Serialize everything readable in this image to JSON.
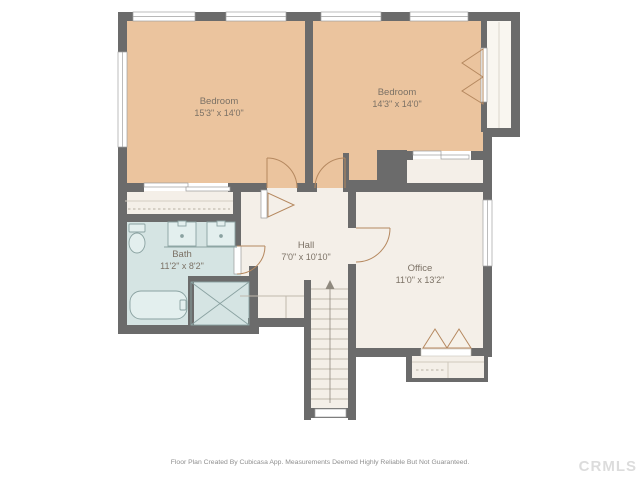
{
  "plan": {
    "rooms": [
      {
        "name": "Bedroom",
        "dimensions": "15'3\" x 14'0\""
      },
      {
        "name": "Bedroom",
        "dimensions": "14'3\" x 14'0\""
      },
      {
        "name": "Bath",
        "dimensions": "11'2\" x 8'2\""
      },
      {
        "name": "Hall",
        "dimensions": "7'0\" x 10'10\""
      },
      {
        "name": "Office",
        "dimensions": "11'0\" x 13'2\""
      }
    ],
    "colors": {
      "wall": "#6b6b6b",
      "bedroom_fill": "#ebc49e",
      "bath_fill": "#d5e4e3",
      "floor_fill": "#f4efe8",
      "door_arc": "#b5885f",
      "fixture_stroke": "#8aa2a1",
      "label_text": "#7b7165",
      "footer_text": "#8f8f8f",
      "watermark": "#dcdcdc"
    }
  },
  "footer": {
    "disclaimer": "Floor Plan Created By Cubicasa App. Measurements Deemed Highly Reliable But Not Guaranteed."
  },
  "watermark": {
    "text": "CRMLS"
  }
}
